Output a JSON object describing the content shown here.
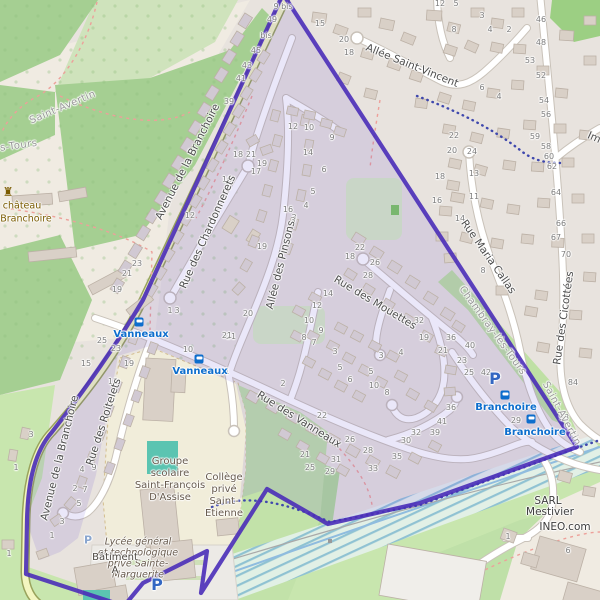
{
  "colors": {
    "boundary": "#4a2db8",
    "tint": "rgba(92,68,205,0.13)",
    "residential": "#e8e3de",
    "forest": "#a5cf92",
    "scrub": "#cfe3bc",
    "grass": "#c8e6ae",
    "pale": "#f0ebe2",
    "school": "#f1edda",
    "pitch": "#5bc4b1",
    "road_casing": "#c9c2b9",
    "road_fill": "#ffffff",
    "avenue_fill": "#f3f6c0",
    "avenue_casing": "#99a35c",
    "building": "#d9d0c7",
    "building_estate": "#d1c9d3",
    "building_stroke": "#bcb1a6",
    "water": "#8fbcdf",
    "number": "#7d7d7d",
    "street": "#4d4d4d",
    "commune": "#979797",
    "transit": "#0d6ecd",
    "parking": "#3367c2",
    "landmark": "#7a5b00",
    "school_text": "#66594c",
    "path_red": "#eda09a",
    "dots_blue": "#3f48ad",
    "powerline": "#a9a9a9"
  },
  "street_labels": [
    {
      "t": "Allée Saint-Vincent",
      "x": 412,
      "y": 66,
      "r": 22
    },
    {
      "t": "Avenue de la Branchoire",
      "x": 188,
      "y": 162,
      "r": -63
    },
    {
      "t": "Avenue de la Branchoire",
      "x": 60,
      "y": 458,
      "r": -76
    },
    {
      "t": "Rue des Chardonnerets",
      "x": 208,
      "y": 232,
      "r": -66
    },
    {
      "t": "Allée des Pinsons",
      "x": 281,
      "y": 265,
      "r": -76
    },
    {
      "t": "Rue des Mouettes",
      "x": 375,
      "y": 303,
      "r": 31
    },
    {
      "t": "Rue des Vanneaux",
      "x": 299,
      "y": 420,
      "r": 32
    },
    {
      "t": "Rue des Roitelets",
      "x": 104,
      "y": 422,
      "r": -72
    },
    {
      "t": "Rue Maria Callas",
      "x": 488,
      "y": 257,
      "r": 55
    },
    {
      "t": "Rue des Cicottées",
      "x": 564,
      "y": 318,
      "r": -82
    },
    {
      "t": "Im",
      "x": 594,
      "y": 138,
      "r": 24
    }
  ],
  "place_labels": [
    {
      "t": "Saint-Avertin",
      "x": 63,
      "y": 108,
      "r": -23,
      "cls": "commune",
      "name": "commune-label-saint-avertin"
    },
    {
      "t": "lès-Tours",
      "x": 14,
      "y": 147,
      "r": -8,
      "cls": "commune",
      "name": "commune-label-les-tours"
    },
    {
      "t": "Chambray-lès-Tours",
      "x": 492,
      "y": 331,
      "r": 54,
      "cls": "commune",
      "name": "commune-label-chambray"
    },
    {
      "t": "Saint-Avertin",
      "x": 561,
      "y": 414,
      "r": 62,
      "cls": "commune",
      "name": "commune-label-saint-avertin-2"
    },
    {
      "t": "château",
      "x": 22,
      "y": 206,
      "r": 0,
      "cls": "castle",
      "name": "castle-label"
    },
    {
      "t": "Branchoire",
      "x": 26,
      "y": 219,
      "r": 0,
      "cls": "castle",
      "name": "castle-label"
    },
    {
      "t": "Groupe",
      "x": 170,
      "y": 462,
      "r": 0,
      "cls": "school",
      "name": "school-label"
    },
    {
      "t": "scolaire",
      "x": 170,
      "y": 474,
      "r": 0,
      "cls": "school",
      "name": "school-label"
    },
    {
      "t": "Saint-François",
      "x": 170,
      "y": 486,
      "r": 0,
      "cls": "school",
      "name": "school-label"
    },
    {
      "t": "D'Assise",
      "x": 170,
      "y": 498,
      "r": 0,
      "cls": "school",
      "name": "school-label"
    },
    {
      "t": "Lycée général",
      "x": 138,
      "y": 542,
      "r": 0,
      "cls": "school-i",
      "name": "school-label"
    },
    {
      "t": "et technologique",
      "x": 138,
      "y": 553,
      "r": 0,
      "cls": "school-i",
      "name": "school-label"
    },
    {
      "t": "privé Sainte-",
      "x": 138,
      "y": 564,
      "r": 0,
      "cls": "school-i",
      "name": "school-label"
    },
    {
      "t": "Marguerite",
      "x": 138,
      "y": 575,
      "r": 0,
      "cls": "school-i",
      "name": "school-label"
    },
    {
      "t": "Collège",
      "x": 224,
      "y": 478,
      "r": 0,
      "cls": "school",
      "name": "school-label"
    },
    {
      "t": "privé",
      "x": 224,
      "y": 490,
      "r": 0,
      "cls": "school",
      "name": "school-label"
    },
    {
      "t": "Saint-",
      "x": 224,
      "y": 502,
      "r": 0,
      "cls": "school",
      "name": "school-label"
    },
    {
      "t": "Etienne",
      "x": 224,
      "y": 514,
      "r": 0,
      "cls": "school",
      "name": "school-label"
    },
    {
      "t": "Bâtiment",
      "x": 115,
      "y": 558,
      "r": 0,
      "cls": "building",
      "name": "building-label"
    },
    {
      "t": "A",
      "x": 115,
      "y": 571,
      "r": 0,
      "cls": "building",
      "name": "building-label"
    },
    {
      "t": "SARL",
      "x": 548,
      "y": 501,
      "r": 0,
      "cls": "poi",
      "name": "company-label"
    },
    {
      "t": "Mestivier",
      "x": 550,
      "y": 512,
      "r": 0,
      "cls": "poi",
      "name": "company-label"
    },
    {
      "t": "INEO.com",
      "x": 565,
      "y": 527,
      "r": 0,
      "cls": "poi",
      "name": "company-label"
    }
  ],
  "transit_stops": [
    {
      "name": "Vanneaux",
      "tx": 141,
      "ty": 335,
      "ix": 139,
      "iy": 322
    },
    {
      "name": "Vanneaux",
      "tx": 200,
      "ty": 372,
      "ix": 199,
      "iy": 359
    },
    {
      "name": "Branchoire",
      "tx": 506,
      "ty": 408,
      "ix": 505,
      "iy": 395
    },
    {
      "name": "Branchoire",
      "tx": 535,
      "ty": 433,
      "ix": 531,
      "iy": 419
    }
  ],
  "parking_markers": [
    {
      "x": 495,
      "y": 379,
      "s": 16
    },
    {
      "x": 157,
      "y": 585,
      "s": 16
    },
    {
      "x": 88,
      "y": 540,
      "s": 11,
      "muted": true
    }
  ],
  "castle": {
    "icon": "♜",
    "ix": 8,
    "iy": 192
  },
  "house_numbers": [
    [
      283,
      7,
      "9 bis"
    ],
    [
      272,
      20,
      "49"
    ],
    [
      266,
      36,
      "bis"
    ],
    [
      256,
      51,
      "45"
    ],
    [
      247,
      66,
      "43"
    ],
    [
      241,
      79,
      "41"
    ],
    [
      229,
      102,
      "39"
    ],
    [
      293,
      127,
      "12"
    ],
    [
      309,
      128,
      "10"
    ],
    [
      332,
      138,
      "9"
    ],
    [
      320,
      24,
      "15"
    ],
    [
      344,
      40,
      "20"
    ],
    [
      349,
      53,
      "18"
    ],
    [
      440,
      4,
      "12"
    ],
    [
      456,
      4,
      "5"
    ],
    [
      482,
      16,
      "3"
    ],
    [
      454,
      30,
      "8"
    ],
    [
      490,
      30,
      "4"
    ],
    [
      509,
      30,
      "2"
    ],
    [
      541,
      20,
      "46"
    ],
    [
      541,
      43,
      "48"
    ],
    [
      530,
      61,
      "53"
    ],
    [
      541,
      76,
      "52"
    ],
    [
      544,
      101,
      "54"
    ],
    [
      546,
      115,
      "56"
    ],
    [
      482,
      88,
      "6"
    ],
    [
      499,
      97,
      "4"
    ],
    [
      535,
      137,
      "59"
    ],
    [
      546,
      147,
      "58"
    ],
    [
      549,
      157,
      "60"
    ],
    [
      552,
      167,
      "62"
    ],
    [
      556,
      193,
      "64"
    ],
    [
      561,
      224,
      "66"
    ],
    [
      556,
      238,
      "67"
    ],
    [
      566,
      255,
      "70"
    ],
    [
      454,
      136,
      "22"
    ],
    [
      452,
      151,
      "20"
    ],
    [
      472,
      152,
      "24"
    ],
    [
      440,
      177,
      "18"
    ],
    [
      474,
      174,
      "13"
    ],
    [
      437,
      201,
      "16"
    ],
    [
      474,
      197,
      "11"
    ],
    [
      460,
      219,
      "14"
    ],
    [
      483,
      271,
      "8"
    ],
    [
      238,
      155,
      "18"
    ],
    [
      251,
      155,
      "21"
    ],
    [
      262,
      164,
      "19"
    ],
    [
      256,
      172,
      "17"
    ],
    [
      227,
      180,
      "16"
    ],
    [
      288,
      210,
      "16"
    ],
    [
      294,
      218,
      "3"
    ],
    [
      190,
      216,
      "12"
    ],
    [
      262,
      247,
      "19"
    ],
    [
      308,
      153,
      "14"
    ],
    [
      324,
      170,
      "6"
    ],
    [
      313,
      192,
      "5"
    ],
    [
      306,
      206,
      "4"
    ],
    [
      293,
      221,
      "3"
    ],
    [
      360,
      248,
      "22"
    ],
    [
      350,
      257,
      "18"
    ],
    [
      375,
      263,
      "26"
    ],
    [
      368,
      276,
      "28"
    ],
    [
      419,
      321,
      "32"
    ],
    [
      424,
      338,
      "19"
    ],
    [
      443,
      351,
      "21"
    ],
    [
      328,
      294,
      "14"
    ],
    [
      317,
      306,
      "12"
    ],
    [
      309,
      321,
      "10"
    ],
    [
      321,
      331,
      "9"
    ],
    [
      304,
      338,
      "8"
    ],
    [
      314,
      343,
      "7"
    ],
    [
      248,
      314,
      "20"
    ],
    [
      231,
      337,
      "21"
    ],
    [
      227,
      372,
      "1"
    ],
    [
      283,
      384,
      "2"
    ],
    [
      335,
      352,
      "3"
    ],
    [
      340,
      368,
      "5"
    ],
    [
      350,
      380,
      "6"
    ],
    [
      381,
      356,
      "3"
    ],
    [
      371,
      372,
      "5"
    ],
    [
      401,
      353,
      "4"
    ],
    [
      374,
      386,
      "10"
    ],
    [
      387,
      393,
      "8"
    ],
    [
      322,
      416,
      "22"
    ],
    [
      350,
      440,
      "26"
    ],
    [
      305,
      455,
      "21"
    ],
    [
      310,
      468,
      "25"
    ],
    [
      330,
      472,
      "29"
    ],
    [
      336,
      460,
      "31"
    ],
    [
      373,
      469,
      "33"
    ],
    [
      397,
      457,
      "35"
    ],
    [
      368,
      451,
      "28"
    ],
    [
      406,
      441,
      "30"
    ],
    [
      416,
      433,
      "32"
    ],
    [
      435,
      433,
      "39"
    ],
    [
      442,
      422,
      "41"
    ],
    [
      451,
      408,
      "36"
    ],
    [
      451,
      338,
      "36"
    ],
    [
      470,
      346,
      "40"
    ],
    [
      462,
      361,
      "23"
    ],
    [
      469,
      373,
      "25"
    ],
    [
      486,
      373,
      "42"
    ],
    [
      516,
      421,
      "29"
    ],
    [
      573,
      383,
      "84"
    ],
    [
      564,
      418,
      "93"
    ],
    [
      508,
      537,
      "1"
    ],
    [
      568,
      551,
      "6"
    ],
    [
      86,
      364,
      "15"
    ],
    [
      102,
      341,
      "25"
    ],
    [
      116,
      349,
      "23"
    ],
    [
      129,
      364,
      "19"
    ],
    [
      113,
      382,
      "12"
    ],
    [
      94,
      468,
      "9"
    ],
    [
      82,
      470,
      "4"
    ],
    [
      75,
      489,
      "2"
    ],
    [
      85,
      490,
      "7"
    ],
    [
      79,
      504,
      "5"
    ],
    [
      62,
      522,
      "3"
    ],
    [
      52,
      536,
      "1"
    ],
    [
      31,
      435,
      "3"
    ],
    [
      16,
      468,
      "1"
    ],
    [
      170,
      311,
      "1"
    ],
    [
      177,
      311,
      "3"
    ],
    [
      227,
      336,
      "21"
    ],
    [
      188,
      350,
      "10"
    ],
    [
      137,
      264,
      "23"
    ],
    [
      127,
      274,
      "21"
    ],
    [
      117,
      290,
      "19"
    ],
    [
      9,
      554,
      "1"
    ]
  ]
}
